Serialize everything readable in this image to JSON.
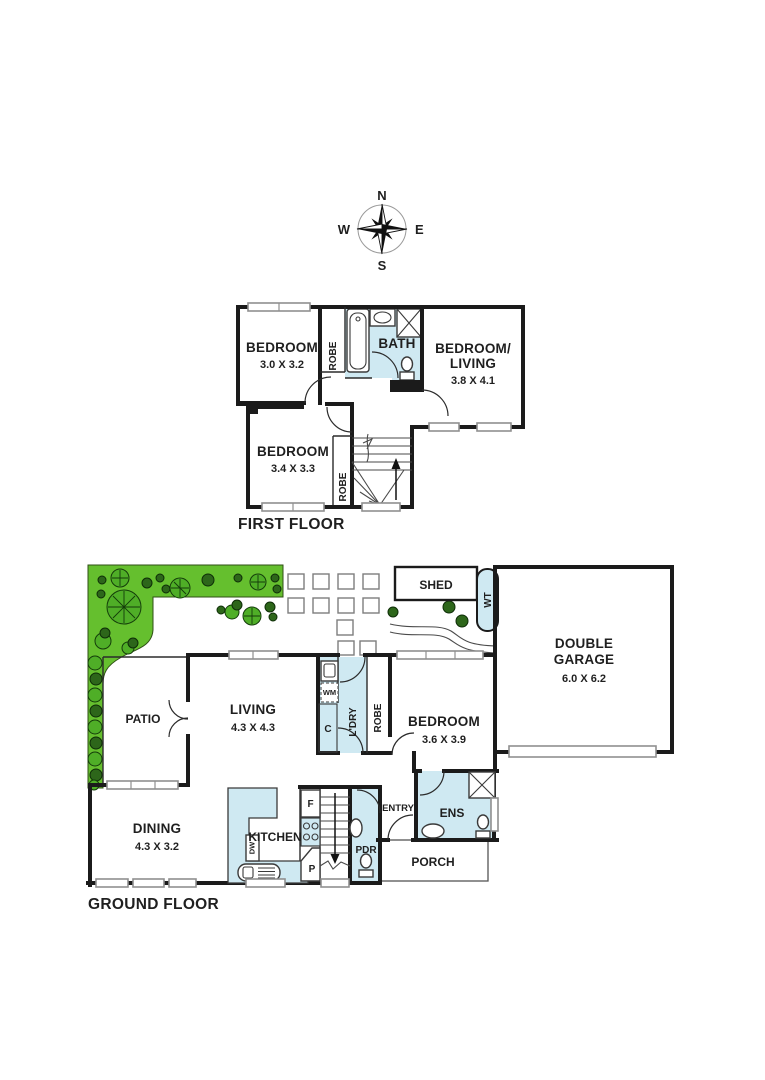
{
  "colors": {
    "wall": "#1b1b1b",
    "wet_area": "#cfe9f2",
    "garden_green": "#65bf2e",
    "tree_light": "#4fae27",
    "tree_dark": "#2d661a",
    "window_border": "#8f8f8f",
    "background": "#ffffff"
  },
  "compass": {
    "n": "N",
    "e": "E",
    "s": "S",
    "w": "W"
  },
  "first_floor": {
    "title": "FIRST FLOOR",
    "bedroom1": {
      "name": "BEDROOM",
      "dims": "3.0 X 3.2"
    },
    "robe1": "ROBE",
    "bath": "BATH",
    "bedroom_living": {
      "line1": "BEDROOM/",
      "line2": "LIVING",
      "dims": "3.8 X 4.1"
    },
    "bedroom2": {
      "name": "BEDROOM",
      "dims": "3.4 X 3.3"
    },
    "robe2": "ROBE"
  },
  "ground_floor": {
    "title": "GROUND FLOOR",
    "shed": "SHED",
    "water_tank": "WT",
    "garage": {
      "line1": "DOUBLE",
      "line2": "GARAGE",
      "dims": "6.0 X 6.2"
    },
    "patio": "PATIO",
    "living": {
      "name": "LIVING",
      "dims": "4.3 X 4.3"
    },
    "laundry": {
      "name": "L'DRY",
      "wm": "WM",
      "cupboard": "C"
    },
    "robe": "ROBE",
    "bedroom": {
      "name": "BEDROOM",
      "dims": "3.6 X 3.9"
    },
    "dining": {
      "name": "DINING",
      "dims": "4.3 X 3.2"
    },
    "kitchen": {
      "name": "KITCHEN",
      "dw": "DW",
      "fridge": "F",
      "pantry": "P"
    },
    "pdr": "PDR",
    "entry": "ENTRY",
    "ens": "ENS",
    "porch": "PORCH"
  }
}
